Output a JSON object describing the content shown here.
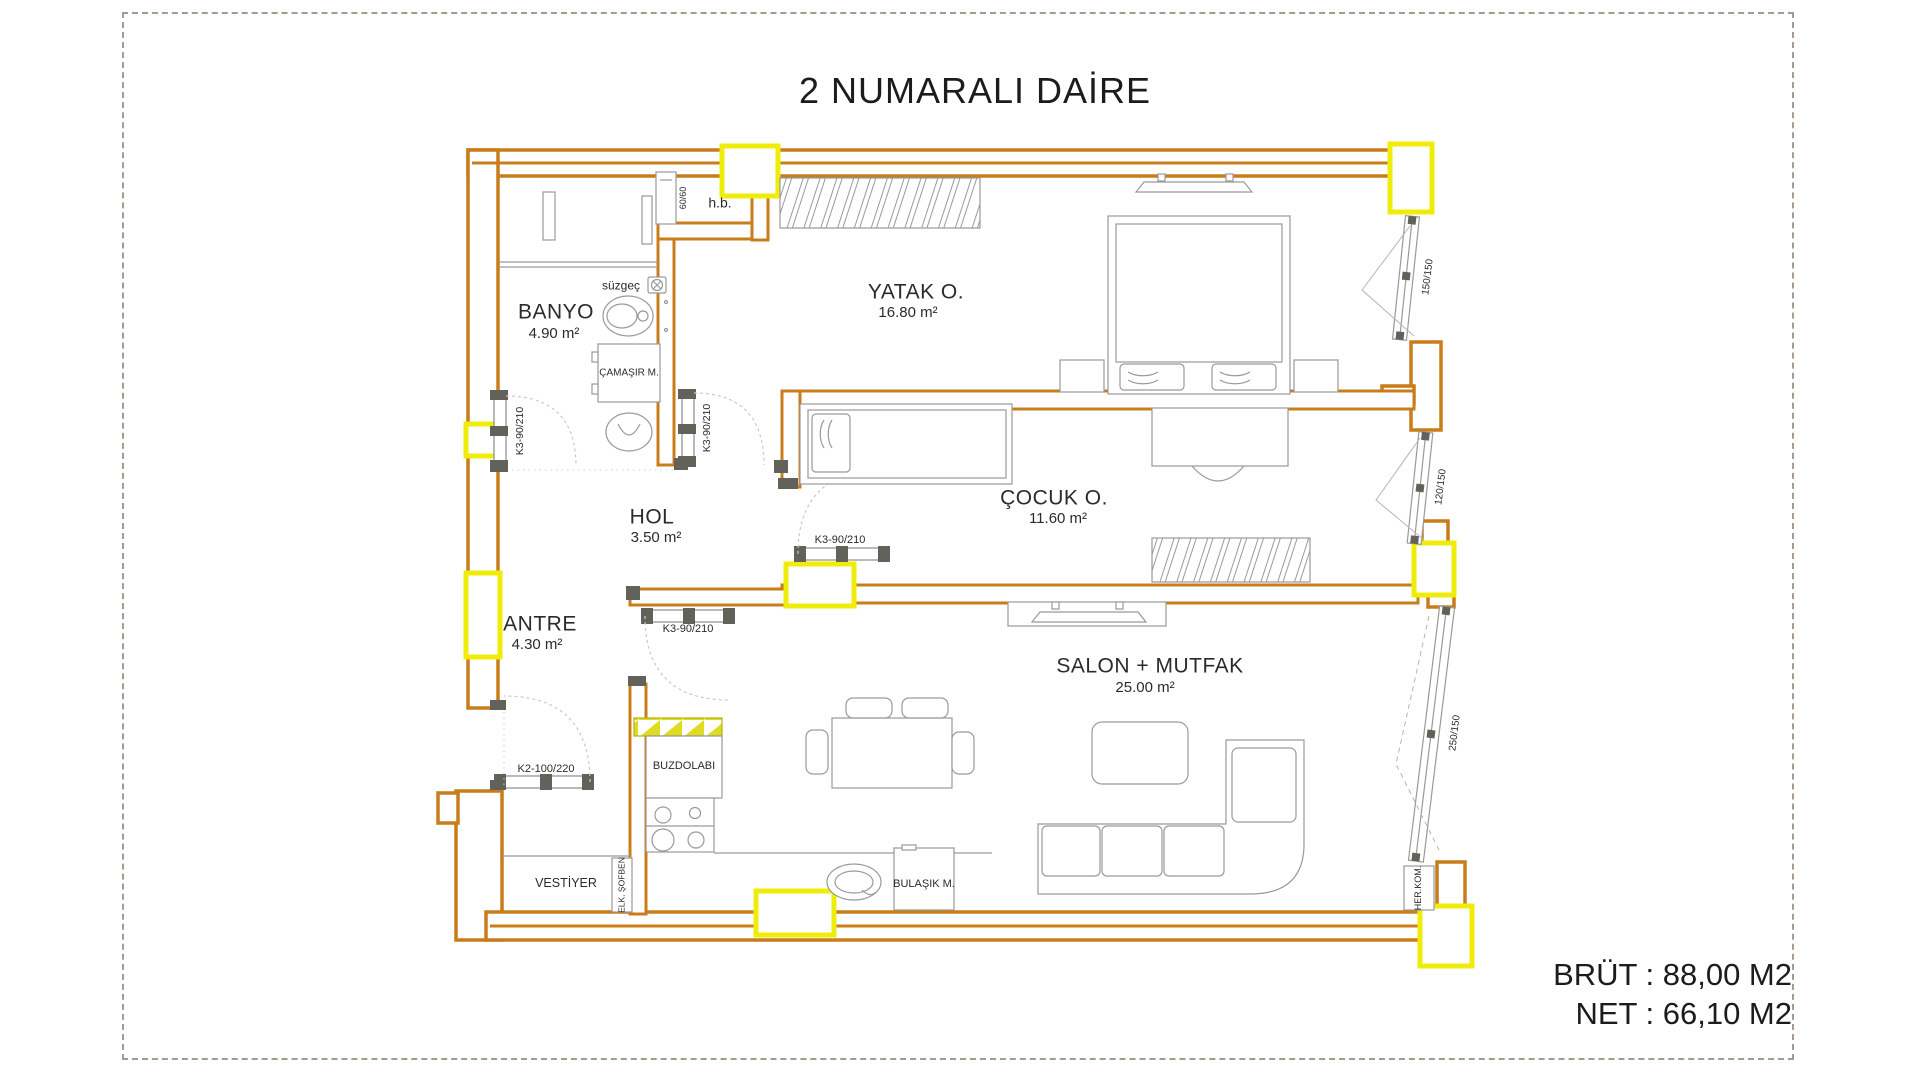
{
  "title": "2 NUMARALI DAİRE",
  "summary": {
    "brut": "BRÜT : 88,00 M2",
    "net": "NET : 66,10 M2"
  },
  "rooms": {
    "banyo": {
      "name": "BANYO",
      "area": "4.90 m²"
    },
    "yatak": {
      "name": "YATAK O.",
      "area": "16.80 m²"
    },
    "cocuk": {
      "name": "ÇOCUK O.",
      "area": "11.60 m²"
    },
    "hol": {
      "name": "HOL",
      "area": "3.50 m²"
    },
    "antre": {
      "name": "ANTRE",
      "area": "4.30 m²"
    },
    "salon": {
      "name": "SALON + MUTFAK",
      "area": "25.00 m²"
    }
  },
  "fixtures": {
    "hb": "h.b.",
    "suzgec": "süzgeç",
    "shower_size": "60/60",
    "camasir": "ÇAMAŞIR M.",
    "buzdolabi": "BUZDOLABI",
    "vestiyer": "VESTİYER",
    "elk_sofben": "ELK. ŞOFBEN",
    "bulasik": "BULAŞIK M.",
    "her_kom": "HER.KOM."
  },
  "doors": {
    "banyo": "K3-90/210",
    "yatak": "K3-90/210",
    "cocuk": "K3-90/210",
    "salon": "K3-90/210",
    "entry": "K2-100/220"
  },
  "windows": {
    "w1": "150/150",
    "w2": "120/150",
    "w3": "250/150"
  },
  "colors": {
    "wall_orange": "#c97c1a",
    "window_yellow": "#f0ec0a",
    "counter_hatch": "#dedb21",
    "furniture_line": "#9a9a9a"
  }
}
